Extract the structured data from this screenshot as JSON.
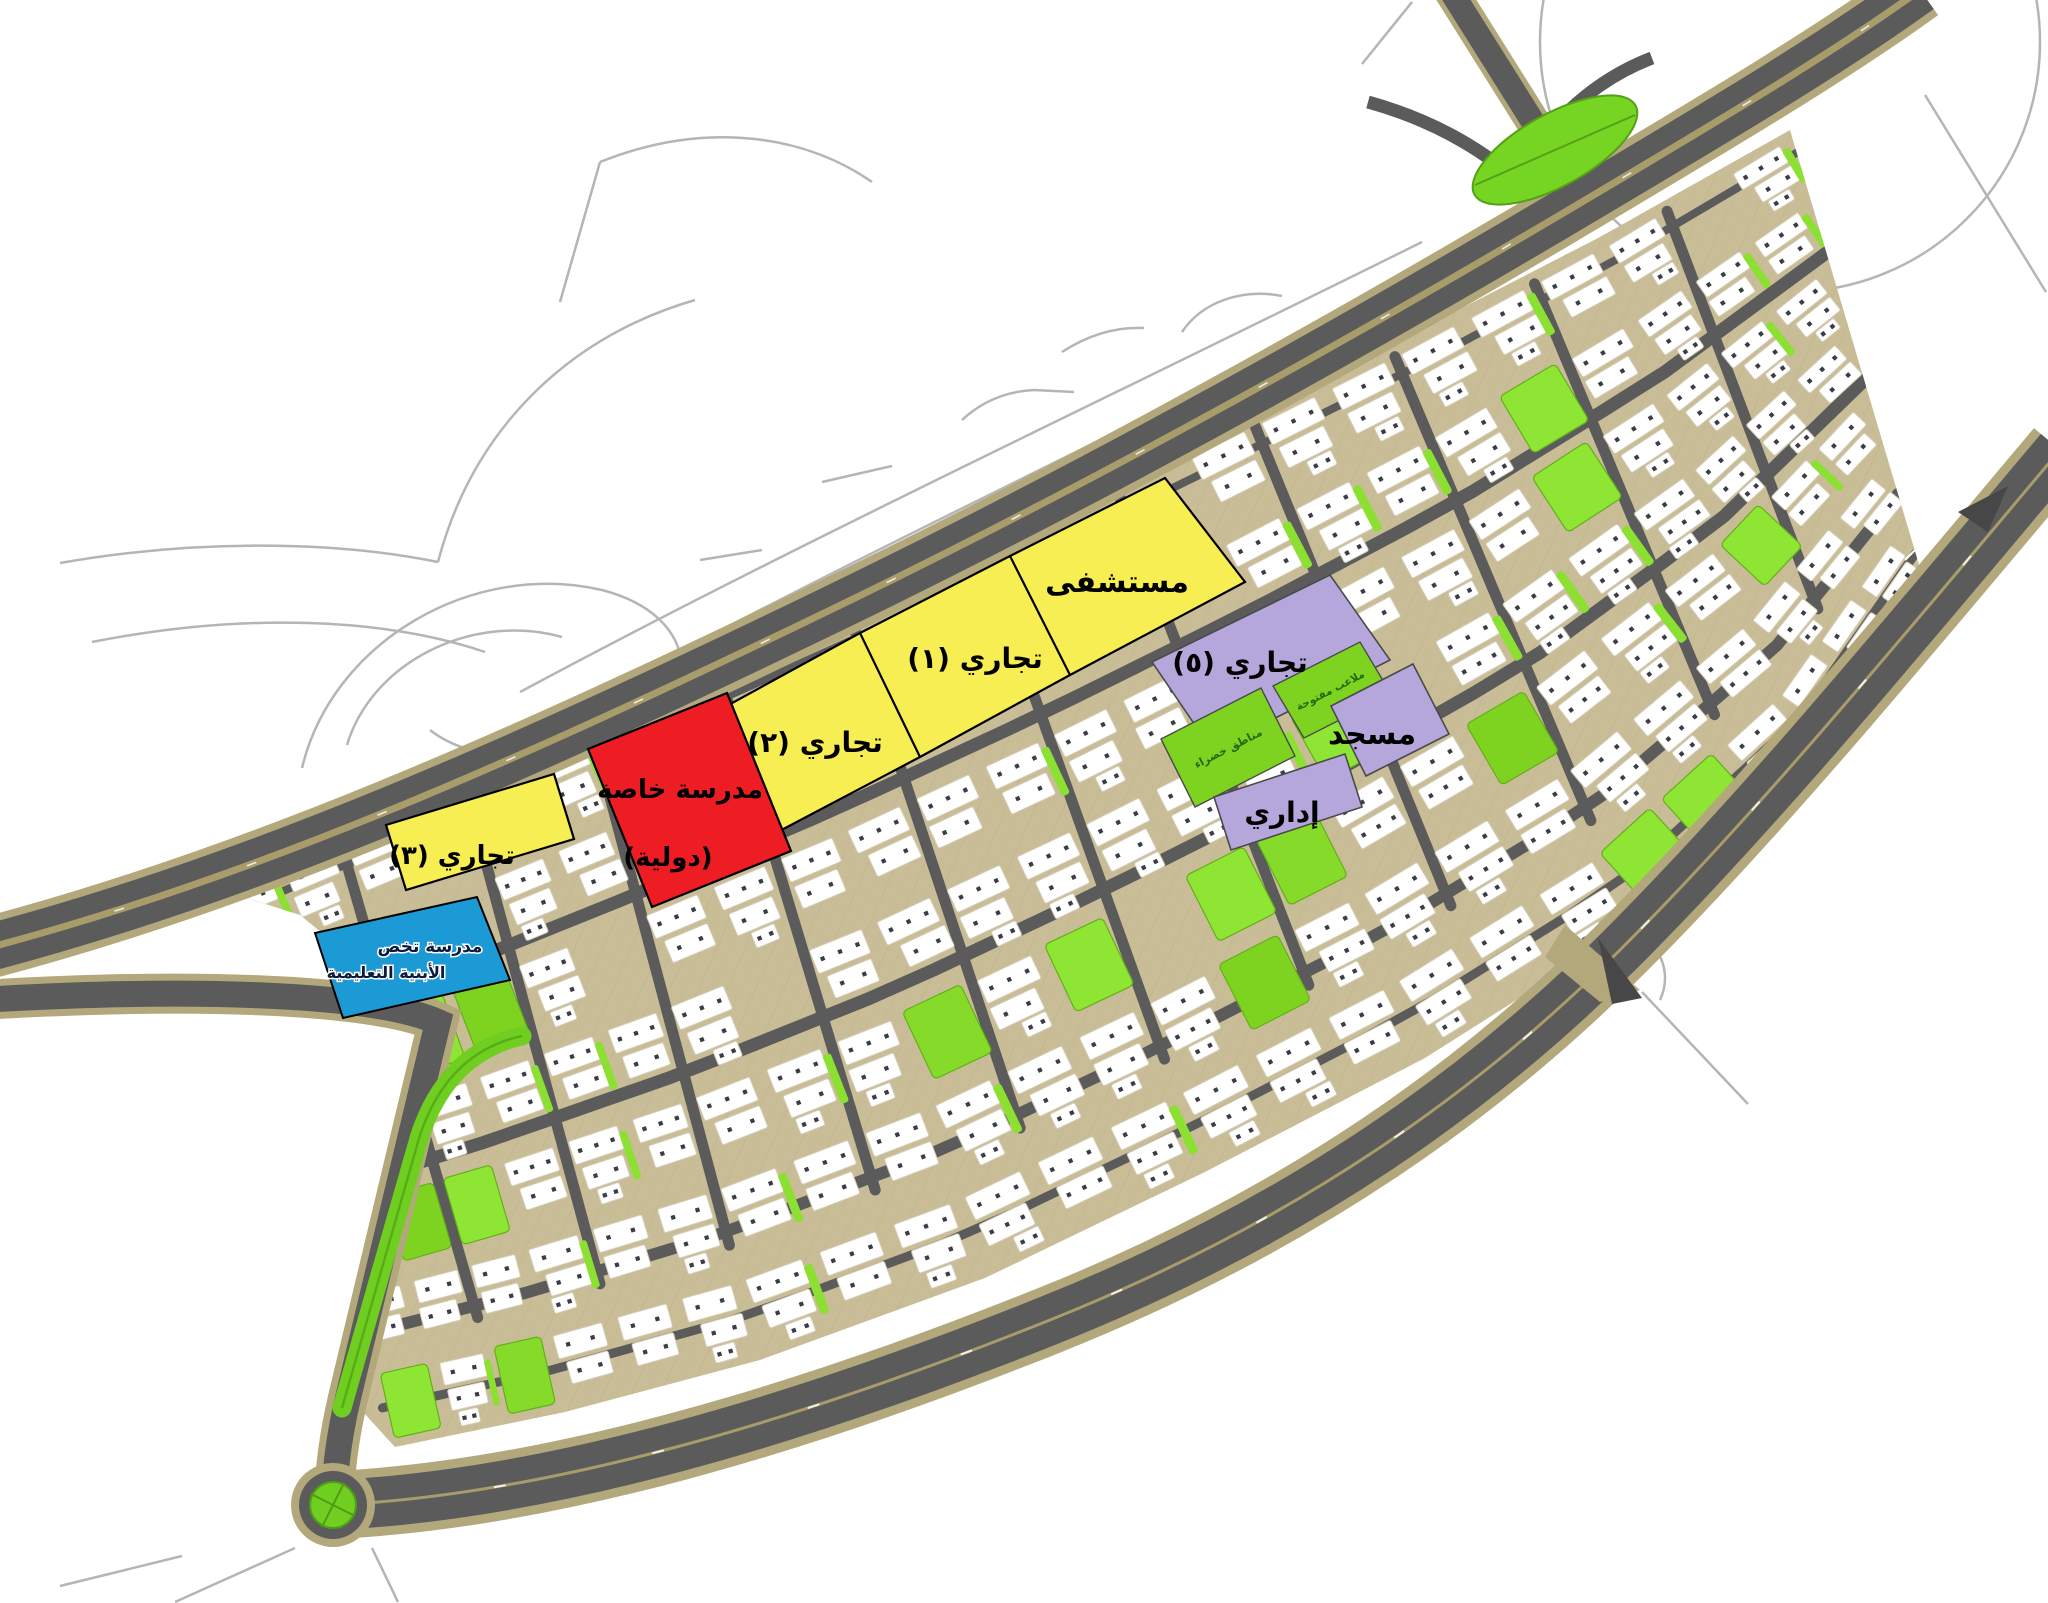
{
  "map": {
    "type": "urban-master-plan",
    "background": "#ffffff",
    "zones": {
      "hospital": {
        "label": "مستشفى",
        "color": "#F6EE52"
      },
      "commercial_1": {
        "label": "تجاري (١)",
        "color": "#F6EE52"
      },
      "commercial_2": {
        "label": "تجاري (٢)",
        "color": "#F6EE52"
      },
      "commercial_3": {
        "label": "تجاري (٣)",
        "color": "#F6EE52"
      },
      "commercial_5": {
        "label": "تجاري (٥)",
        "color": "#B5A7DC"
      },
      "private_school": {
        "label_line1": "مدرسة خاصة",
        "label_line2": "(دولية)",
        "color": "#EE1D23"
      },
      "specialized_school": {
        "label_line1": "مدرسة تخص",
        "label_line2": "الأبنية التعليمية",
        "color": "#1C9AD6"
      },
      "mosque": {
        "label": "مسجد",
        "color": "#B5A7DC"
      },
      "admin": {
        "label": "إداري",
        "color": "#B5A7DC"
      },
      "open_playgrounds": {
        "label": "ملاعب مفتوحة",
        "color": "#7ED321"
      },
      "green_areas": {
        "label": "مناطق خضراء",
        "color": "#7ED321"
      }
    },
    "palette": {
      "road_asphalt": "#5B5B5B",
      "road_median_tan": "#A99C6B",
      "road_edge_tan": "#B3A87B",
      "site_base_tan": "#C9BD97",
      "park_green": "#7ED321",
      "roundabout_green": "#6FCE1F",
      "building_white": "#FFFFFF",
      "building_window": "#3C3C48",
      "outline_road_gray": "#B5B5B5",
      "zone_label_black": "#000000",
      "school_label_navy": "#0D1B3D",
      "green_label_dark": "#1E6B10"
    }
  }
}
